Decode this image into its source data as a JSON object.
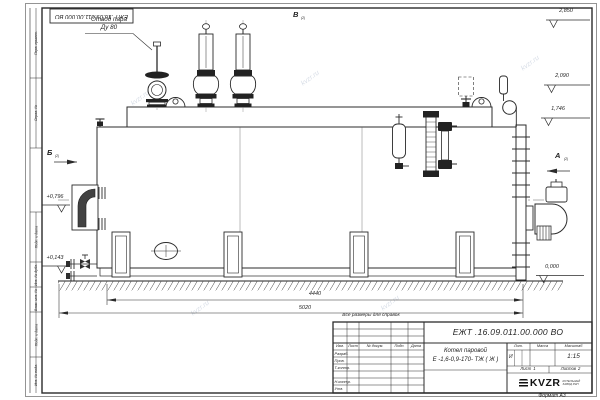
{
  "watermark": "kvzr.ru",
  "stamp": {
    "number": "ЕЖТ .16.09.011.00.000 ВО"
  },
  "callouts": {
    "steam_outlet_1": "Отвод пара",
    "steam_outlet_2": "Ду 80"
  },
  "views": {
    "top": "В",
    "top_ref": "(2)",
    "left": "Б",
    "left_ref": "(2)",
    "right": "А",
    "right_ref": "(2)"
  },
  "elevations": {
    "h1": "2,850",
    "h2": "2,090",
    "h3": "1,746",
    "ground": "0,000",
    "l1": "+0,796",
    "l2": "+0,143"
  },
  "dimensions": {
    "span": "4440",
    "overall": "5020"
  },
  "note": "Все размеры для справок",
  "margin": [
    "Перв. примен.",
    "Справ. №",
    "Подп. и дата",
    "Инв. № дубл.",
    "Взам. инв. №",
    "Подп. и дата",
    "Инв. № подл."
  ],
  "title_block": {
    "designation": "ЕЖТ .16.09.011.00.000 ВО",
    "name_1": "Котел паровой",
    "name_2": "Е -1,6-0,9-170- ТЖ ( Ж )",
    "col_izm": "Изм.",
    "col_list": "Лист",
    "col_doc": "№ докум.",
    "col_sign": "Подп.",
    "col_date": "Дата",
    "row_1": "Разраб.",
    "row_2": "Пров.",
    "row_3": "Т.контр.",
    "row_4": "Н.контр.",
    "row_5": "Утв.",
    "lit_label": "Лит.",
    "mass_label": "Масса",
    "scale_label": "Масштаб",
    "lit_value": "И",
    "scale_value": "1:15",
    "sheet_label": "Лист",
    "sheet_value": "1",
    "sheets_label": "Листов",
    "sheets_value": "2",
    "logo": "KVZR",
    "logo_sub_1": "КОТЕЛЬНЫЙ",
    "logo_sub_2": "ЗАВОД РЭП",
    "format": "Формат А3"
  }
}
